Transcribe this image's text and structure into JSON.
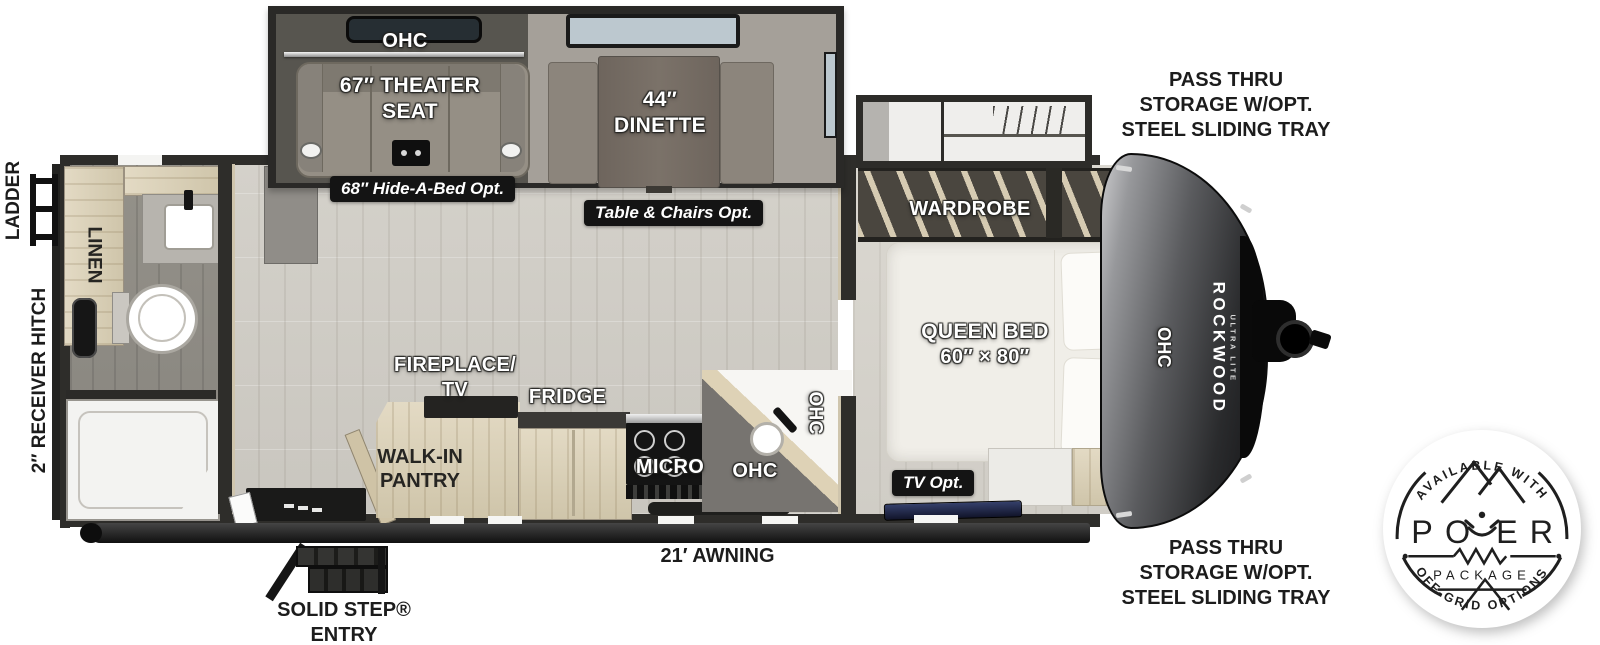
{
  "colors": {
    "wall": "#2e2d2a",
    "floor_main": "#cfccc5",
    "floor_bath": "#8e8b86",
    "floor_bedroom": "#d6d3cc",
    "light_wood": "#d9d0ba",
    "slide_dark": "#57554f",
    "slide_light": "#a5a099",
    "badge_bg": "#141414",
    "label_white": "#ffffff",
    "label_black": "#1c1c1c",
    "front_cap_dark": "#2a2b2d",
    "bed_white": "#f0eee8"
  },
  "labels": {
    "ohc": "OHC",
    "theater_l1": "67″ THEATER",
    "theater_l2": "SEAT",
    "dinette_l1": "44″",
    "dinette_l2": "DINETTE",
    "hide_a_bed": "68″ Hide-A-Bed Opt.",
    "table_chairs": "Table & Chairs Opt.",
    "linen": "LINEN",
    "wardrobe": "WARDROBE",
    "queen_l1": "QUEEN BED",
    "queen_l2": "60″ × 80″",
    "tv_opt": "TV Opt.",
    "fireplace_l1": "FIREPLACE/",
    "fireplace_l2": "TV",
    "fridge": "FRIDGE",
    "pantry_l1": "WALK-IN",
    "pantry_l2": "PANTRY",
    "micro": "MICRO",
    "ladder": "LADDER",
    "hitch": "2″ RECEIVER HITCH",
    "awning": "21′ AWNING",
    "solid_step_l1": "SOLID STEP®",
    "solid_step_l2": "ENTRY",
    "pass_thru_l1": "PASS THRU",
    "pass_thru_l2": "STORAGE W/OPT.",
    "pass_thru_l3": "STEEL SLIDING TRAY"
  },
  "branding": {
    "name": "ROCKWOOD",
    "sub": "ULTRA LITE"
  },
  "badge": {
    "arc_top": "AVAILABLE WITH",
    "po": "PO",
    "er": "ER",
    "package": "PACKAGE",
    "arc_bottom": "OFF-GRID OPTIONS"
  }
}
